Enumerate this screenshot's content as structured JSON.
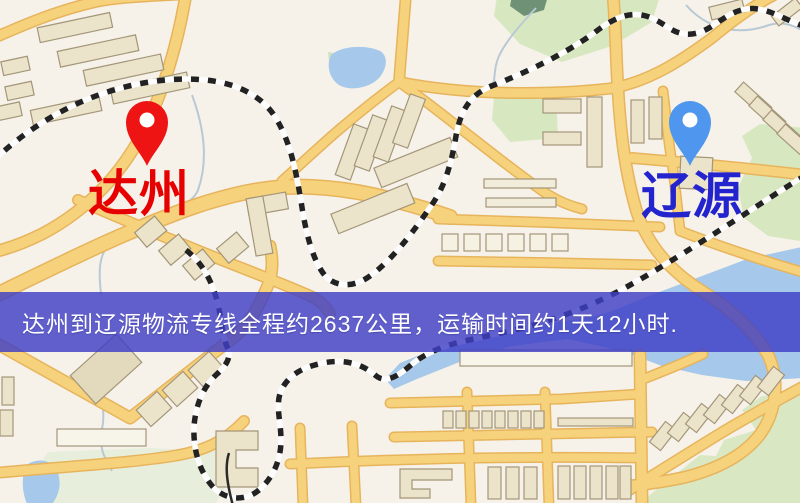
{
  "map": {
    "markers": [
      {
        "id": "origin",
        "label": "达州",
        "pin_color": "#ee1414",
        "label_color": "#e60000"
      },
      {
        "id": "destination",
        "label": "辽源",
        "pin_color": "#4f97ee",
        "label_color": "#2424cf"
      }
    ],
    "route": {
      "origin": "达州",
      "destination": "辽源",
      "distance_text": "约2637公里",
      "duration_text": "约1天12小时"
    },
    "banner": {
      "text": "达州到辽源物流专线全程约2637公里，运输时间约1天12小时.",
      "background_color": "#3e3ec6",
      "text_color": "#ffffff"
    },
    "palette": {
      "background": "#f6f2ea",
      "road": "#f6d27d",
      "road_casing": "#e7b45c",
      "building": "#ece3cb",
      "building_outline": "#a39678",
      "park_green": "#d7e8c0",
      "water_blue": "#a6c8ea",
      "railway_dash": "#222222"
    }
  }
}
